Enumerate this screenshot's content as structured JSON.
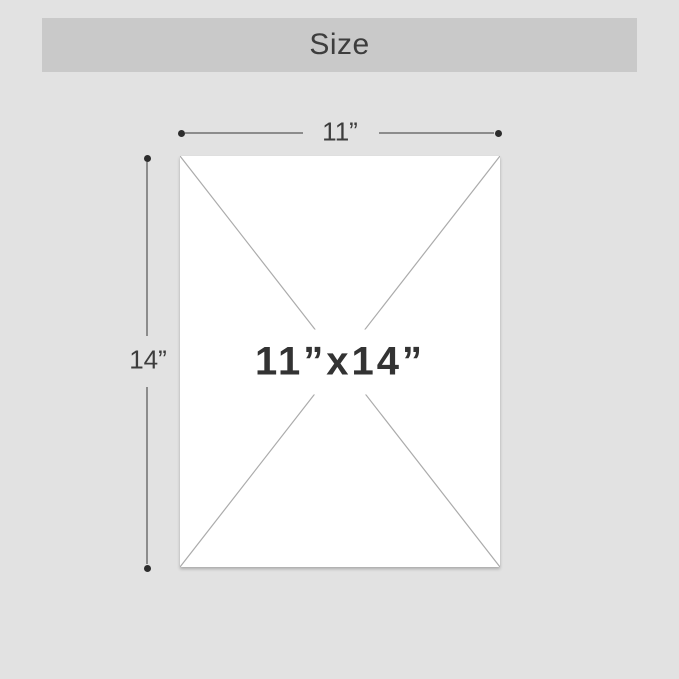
{
  "header": {
    "title": "Size"
  },
  "diagram": {
    "paper": {
      "label": "11”x14”"
    },
    "width_dimension": {
      "label": "11”"
    },
    "height_dimension": {
      "label": "14”"
    }
  },
  "colors": {
    "page_background": "#e2e2e2",
    "header_background": "#c9c9c9",
    "header_text": "#3d3d3d",
    "paper_fill": "#ffffff",
    "paper_label_text": "#333333",
    "diagonal_line": "#ababab",
    "dimension_line": "#8c8c8c",
    "dimension_text": "#3d3d3d",
    "endpoint_dot": "#2d2d2d"
  }
}
